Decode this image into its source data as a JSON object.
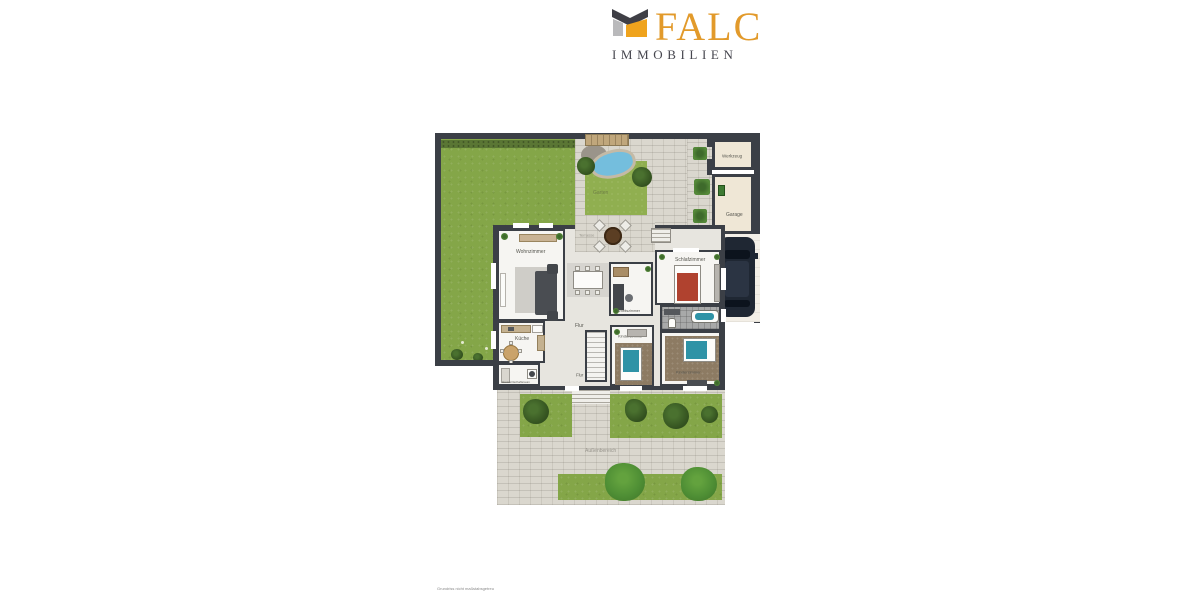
{
  "logo": {
    "brand": "FALC",
    "subtitle": "IMMOBILIEN",
    "accent_color": "#E29A2B",
    "subtitle_color": "#46464E",
    "icon": "falc-house-icon"
  },
  "floorplan": {
    "labels": {
      "werkzeug": "Werkzeug",
      "garage": "Garage",
      "garten": "Garten",
      "terrasse": "Terrasse",
      "wohnzimmer": "Wohnzimmer",
      "arbeitszimmer": "Arbeitszimmer",
      "schlafzimmer": "Schlafzimmer",
      "flur_oben": "Flur",
      "kueche": "Küche",
      "hauswirtschaftsraum": "Hauswirtschaftsraum",
      "flur_unten": "Flur",
      "kinderzimmer_mitte": "Kinderzimmer",
      "kinderzimmer_rechts": "Kinderzimmer",
      "aussenbereich": "Außenbereich"
    },
    "disclaimer": "Grundriss nicht maßstabsgetreu",
    "colors": {
      "wall": "#3B3F46",
      "grass": "#84A648",
      "paving": "#DAD7CE",
      "pond": "#74BEDD",
      "bed_red": "#B0422F",
      "bed_teal": "#2F93A6",
      "car": "#1F2733",
      "room_beige": "#EFE7D6"
    }
  }
}
